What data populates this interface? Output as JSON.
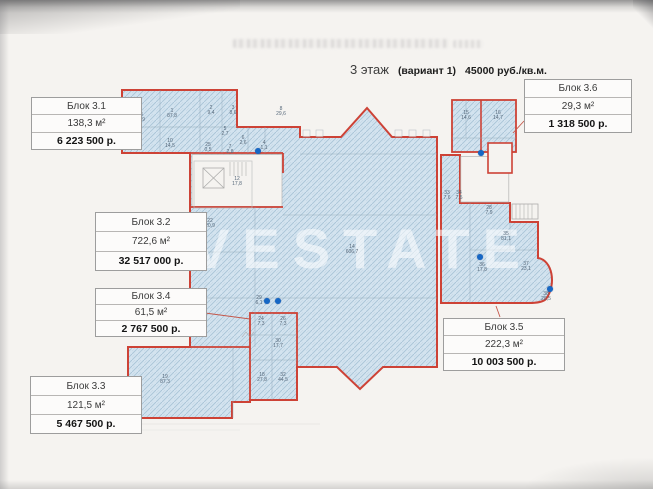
{
  "title": {
    "floor": "3 этаж",
    "variant": "(вариант 1)",
    "rate": "45000 руб./кв.м."
  },
  "watermark": "VESTATE",
  "blocks": [
    {
      "name": "Блок 3.1",
      "area": "138,3 м²",
      "price": "6 223 500 р."
    },
    {
      "name": "Блок 3.2",
      "area": "722,6 м²",
      "price": "32 517 000 р."
    },
    {
      "name": "Блок 3.3",
      "area": "121,5 м²",
      "price": "5 467 500 р."
    },
    {
      "name": "Блок 3.4",
      "area": "61,5 м²",
      "price": "2 767 500 р."
    },
    {
      "name": "Блок 3.5",
      "area": "222,3 м²",
      "price": "10 003 500 р."
    },
    {
      "name": "Блок 3.6",
      "area": "29,3 м²",
      "price": "1 318 500 р."
    }
  ],
  "colors": {
    "plan_outline": "#cd4236",
    "plan_fill": "#d3e3ef",
    "plan_hatch": "#a9c3d6",
    "marker_dot": "#1667c5",
    "paper": "#f5f3f0"
  },
  "plan": {
    "rooms": [
      {
        "n": "23",
        "a": "13,9",
        "x": 140,
        "y": 118
      },
      {
        "n": "1",
        "a": "87,8",
        "x": 172,
        "y": 114
      },
      {
        "n": "10",
        "a": "14,5",
        "x": 170,
        "y": 144
      },
      {
        "n": "2",
        "a": "9,4",
        "x": 211,
        "y": 111
      },
      {
        "n": "3",
        "a": "8,6",
        "x": 233,
        "y": 111
      },
      {
        "n": "8",
        "a": "29,6",
        "x": 281,
        "y": 112
      },
      {
        "n": "5",
        "a": "2,7",
        "x": 225,
        "y": 132
      },
      {
        "n": "25",
        "a": "0,5",
        "x": 208,
        "y": 148
      },
      {
        "n": "7",
        "a": "2,8",
        "x": 230,
        "y": 150
      },
      {
        "n": "6",
        "a": "2,6",
        "x": 243,
        "y": 141
      },
      {
        "n": "4",
        "a": "1,1",
        "x": 264,
        "y": 146
      },
      {
        "n": "12",
        "a": "17,8",
        "x": 237,
        "y": 182
      },
      {
        "n": "22",
        "a": "20,9",
        "x": 210,
        "y": 224
      },
      {
        "n": "14",
        "a": "606,7",
        "x": 352,
        "y": 250
      },
      {
        "n": "15",
        "a": "14,6",
        "x": 466,
        "y": 116
      },
      {
        "n": "16",
        "a": "14,7",
        "x": 498,
        "y": 116
      },
      {
        "n": "33",
        "a": "7,6",
        "x": 447,
        "y": 196
      },
      {
        "n": "34",
        "a": "7,5",
        "x": 459,
        "y": 196
      },
      {
        "n": "28",
        "a": "7,9",
        "x": 489,
        "y": 211
      },
      {
        "n": "35",
        "a": "81,1",
        "x": 506,
        "y": 237
      },
      {
        "n": "36",
        "a": "17,8",
        "x": 482,
        "y": 268
      },
      {
        "n": "37",
        "a": "23,1",
        "x": 526,
        "y": 267
      },
      {
        "n": "38",
        "a": "28,5",
        "x": 546,
        "y": 297
      },
      {
        "n": "29",
        "a": "6,1",
        "x": 259,
        "y": 301
      },
      {
        "n": "24",
        "a": "7,3",
        "x": 261,
        "y": 322
      },
      {
        "n": "26",
        "a": "7,3",
        "x": 283,
        "y": 322
      },
      {
        "n": "30",
        "a": "17,7",
        "x": 278,
        "y": 344
      },
      {
        "n": "18",
        "a": "27,8",
        "x": 262,
        "y": 378
      },
      {
        "n": "32",
        "a": "44,5",
        "x": 283,
        "y": 378
      },
      {
        "n": "19",
        "a": "87,3",
        "x": 165,
        "y": 380
      }
    ],
    "dots": [
      [
        258,
        151
      ],
      [
        481,
        153
      ],
      [
        267,
        301
      ],
      [
        278,
        301
      ],
      [
        480,
        257
      ],
      [
        550,
        289
      ]
    ]
  }
}
